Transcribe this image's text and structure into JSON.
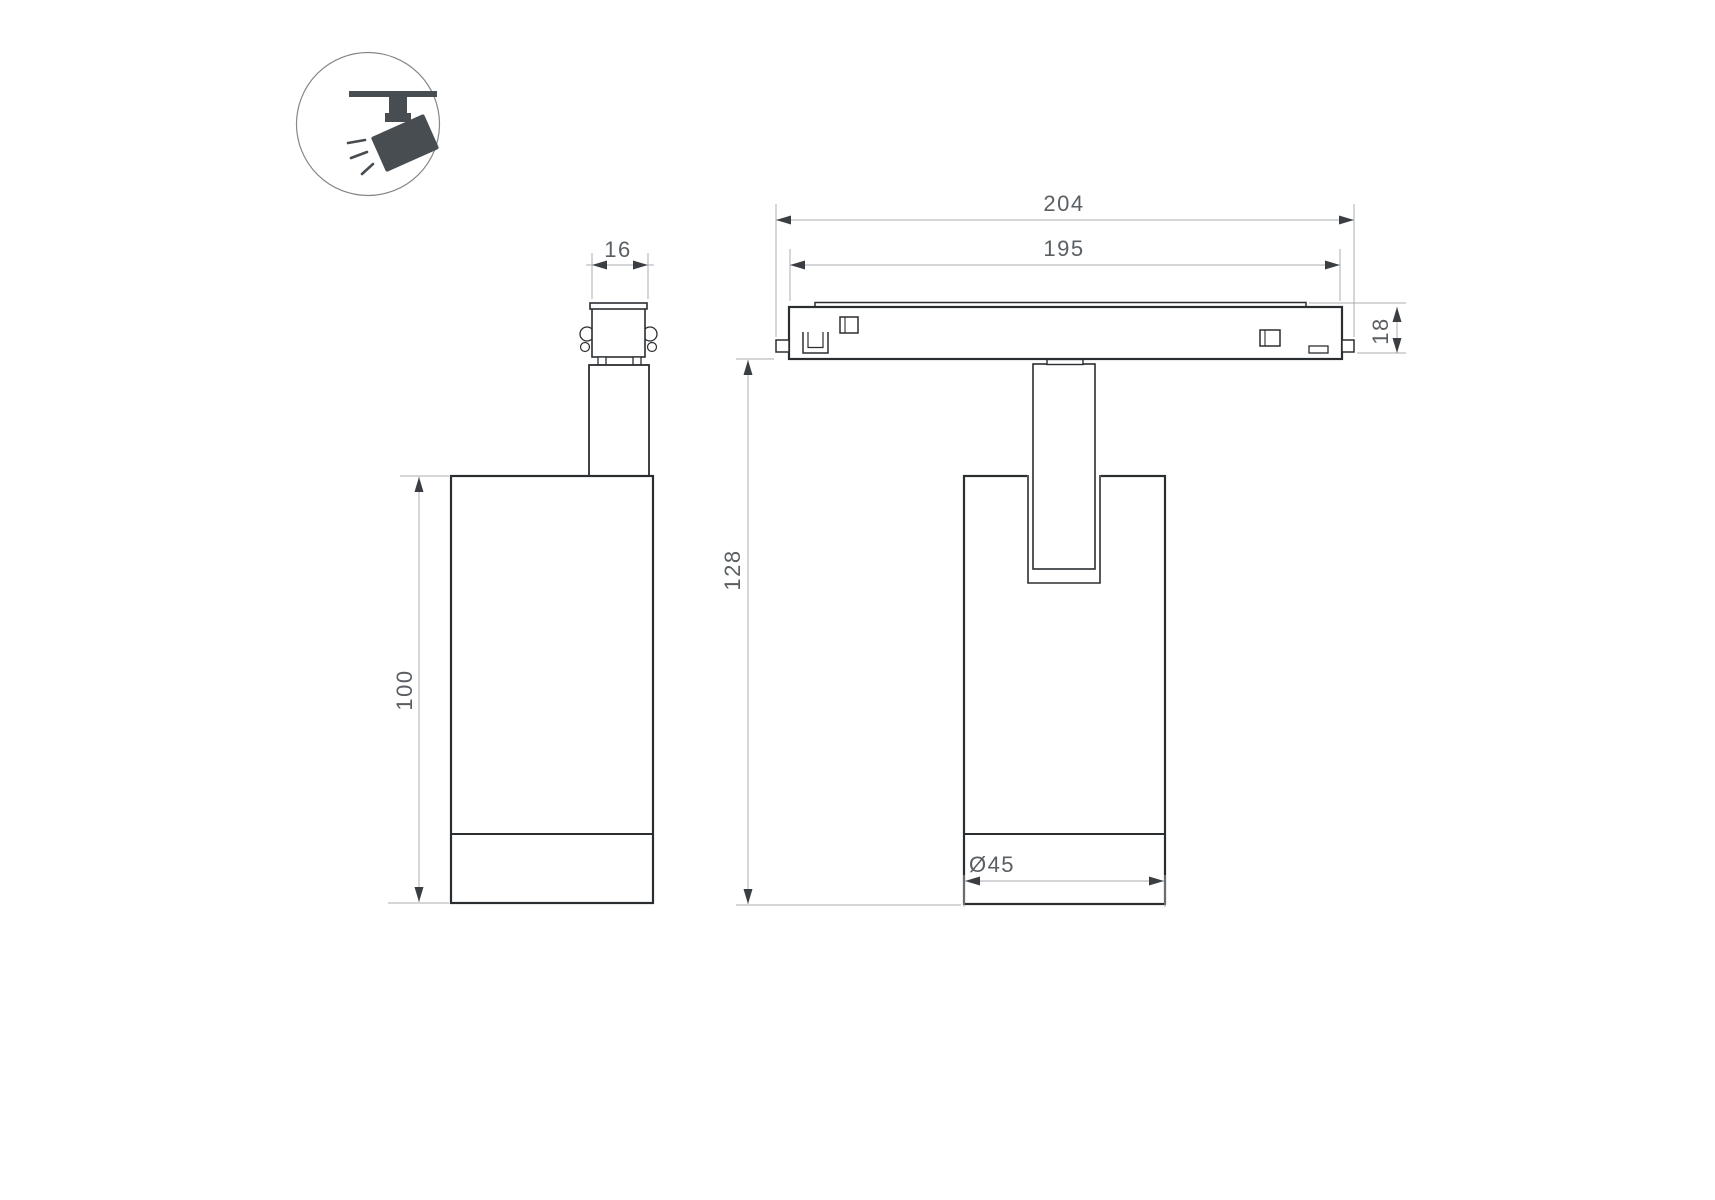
{
  "drawing": {
    "title": "track-spotlight-dimension-drawing",
    "icon": {
      "name": "ceiling-track-spotlight-icon"
    },
    "dimensions": {
      "adapter_width": "16",
      "body_height": "100",
      "track_overall_width": "204",
      "track_inner_width": "195",
      "track_height": "18",
      "fixture_height": "128",
      "body_diameter": "Ø45"
    },
    "colors": {
      "outline": "#2b2e31",
      "dimension_line": "#a9adb0",
      "arrowhead": "#3a3e42",
      "dimension_text": "#5a5f63",
      "icon_fill": "#484d52",
      "background": "#ffffff"
    }
  }
}
